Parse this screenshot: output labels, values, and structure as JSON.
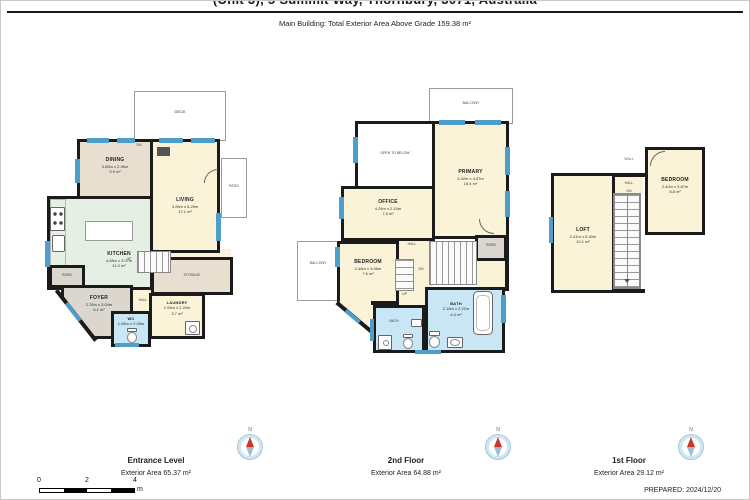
{
  "header": {
    "title": "(Unit 3), 5 Summit Way, Thornbury, 3071, Australia",
    "subtitle": "Main Building: Total Exterior Area Above Grade 159.38 m²"
  },
  "plans": {
    "entrance": {
      "deck": "DECK",
      "dn": "DN",
      "patio": "PATIO",
      "dining": {
        "name": "DINING",
        "dims": "3.65m x 2.96m",
        "area": "9.9 m²"
      },
      "living": {
        "name": "LIVING",
        "dims": "3.26m x 5.29m",
        "area": "17.1 m²"
      },
      "kitchen": {
        "name": "KITCHEN",
        "dims": "4.08m x 3.07m",
        "area": "11.0 m²"
      },
      "robe": "ROBE",
      "foyer": {
        "name": "FOYER",
        "dims": "2.76m x 3.04m",
        "area": "6.1 m²"
      },
      "hall": "HALL",
      "up": "UP",
      "storage": "STORAGE",
      "laundry": {
        "name": "LAUNDRY",
        "dims": "1.94m x 2.20m",
        "area": "3.7 m²"
      },
      "wc": {
        "name": "WC",
        "dims": "1.06m x 2.05m"
      }
    },
    "second": {
      "balcony_top": "BALCONY",
      "open_to_below": "OPEN TO BELOW",
      "primary": {
        "name": "PRIMARY",
        "dims": "3.42m x 4.57m",
        "area": "15.4 m²"
      },
      "office": {
        "name": "OFFICE",
        "dims": "4.24m x 2.10m",
        "area": "7.8 m²"
      },
      "hall": "HALL",
      "robe": "ROBE",
      "balcony_left": "BALCONY",
      "bedroom": {
        "name": "BEDROOM",
        "dims": "2.46m x 3.06m",
        "area": "7.6 m²"
      },
      "bath": {
        "name": "BATH",
        "dims": "2.16m x 2.22m",
        "area": "4.4 m²"
      },
      "bath_small": "BATH",
      "up": "UP",
      "dn": "DN"
    },
    "first": {
      "wall": "WALL",
      "hall": "HALL",
      "dn": "DN",
      "loft": {
        "name": "LOFT",
        "dims": "2.41m x 5.40m",
        "area": "10.1 m²"
      },
      "bedroom": {
        "name": "BEDROOM",
        "dims": "2.40m x 3.87m",
        "area": "8.8 m²"
      }
    }
  },
  "footer": {
    "floors": [
      {
        "name": "Entrance Level",
        "area": "Exterior Area 65.37 m²"
      },
      {
        "name": "2nd Floor",
        "area": "Exterior Area 64.88 m²"
      },
      {
        "name": "1st Floor",
        "area": "Exterior Area 29.12 m²"
      }
    ],
    "compass_label": "N",
    "scale": {
      "t0": "0",
      "t2": "2",
      "t4": "4",
      "unit": "m"
    },
    "prepared": "PREPARED: 2024/12/20"
  },
  "colors": {
    "wall": "#1b1b1b",
    "window": "#4d9ecb",
    "room_cream": "#fbf3d8",
    "room_tan": "#e8dfd0",
    "room_green": "#e6efe3",
    "room_gray": "#dbd6ce",
    "room_blue": "#c9e6f4"
  }
}
